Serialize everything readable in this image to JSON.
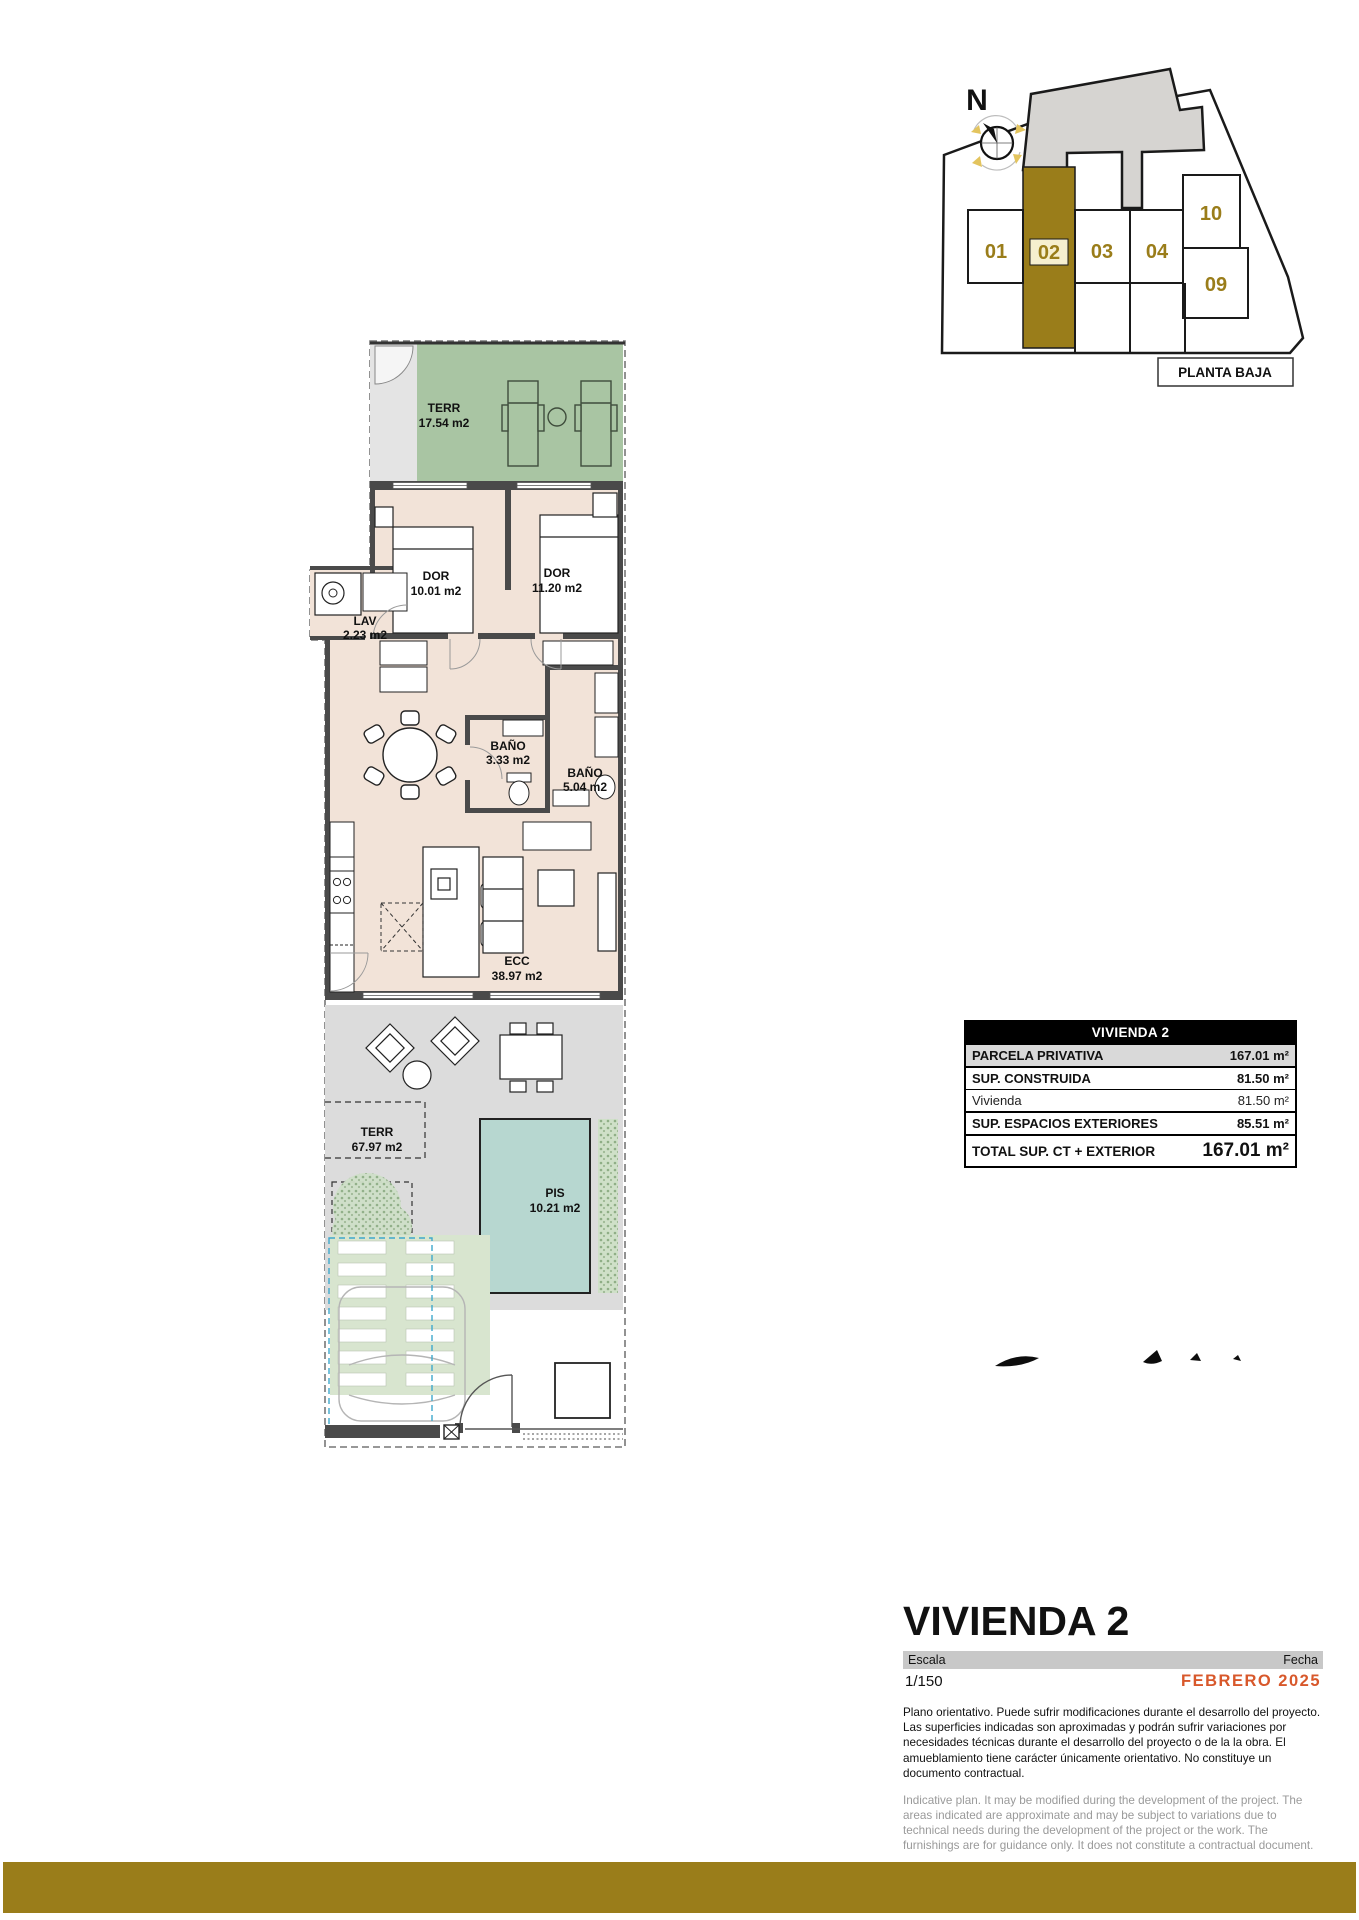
{
  "site_map": {
    "north_label": "N",
    "floor_label": "PLANTA BAJA",
    "units": {
      "u01": "01",
      "u02": "02",
      "u03": "03",
      "u04": "04",
      "u09": "09",
      "u10": "10"
    },
    "highlighted_unit": "02",
    "accent_color": "#9a7d1a"
  },
  "plan": {
    "rooms": {
      "terr_top": {
        "name": "TERR",
        "area": "17.54 m2"
      },
      "dor1": {
        "name": "DOR",
        "area": "10.01 m2"
      },
      "dor2": {
        "name": "DOR",
        "area": "11.20 m2"
      },
      "lav": {
        "name": "LAV",
        "area": "2.23 m2"
      },
      "bano1": {
        "name": "BAÑO",
        "area": "3.33 m2"
      },
      "bano2": {
        "name": "BAÑO",
        "area": "5.04 m2"
      },
      "ecc": {
        "name": "ECC",
        "area": "38.97 m2"
      },
      "terr_bottom": {
        "name": "TERR",
        "area": "67.97 m2"
      },
      "pis": {
        "name": "PIS",
        "area": "10.21 m2"
      }
    }
  },
  "summary_table": {
    "header": "VIVIENDA 2",
    "rows": [
      {
        "label": "PARCELA PRIVATIVA",
        "value": "167.01 m²"
      },
      {
        "label": "SUP. CONSTRUIDA",
        "value": "81.50 m²"
      },
      {
        "label": "Vivienda",
        "value": "81.50 m²"
      },
      {
        "label": "SUP. ESPACIOS EXTERIORES",
        "value": "85.51 m²"
      },
      {
        "label": "TOTAL SUP. CT + EXTERIOR",
        "value": "167.01 m²"
      }
    ]
  },
  "title_block": {
    "title": "VIVIENDA 2",
    "scale_label": "Escala",
    "scale_value": "1/150",
    "date_label": "Fecha",
    "date_value": "FEBRERO 2025",
    "disclaimer_es": "Plano orientativo. Puede sufrir modificaciones durante el desarrollo del proyecto. Las superficies indicadas son aproximadas y podrán sufrir variaciones por necesidades técnicas durante el desarrollo del proyecto o de la la obra. El amueblamiento tiene carácter únicamente orientativo. No constituye un documento contractual.",
    "disclaimer_en": "Indicative plan. It may be modified during the development of the project. The areas indicated are approximate and may be subject to variations due to technical needs during the development of the project or the work. The furnishings are for guidance only. It does not constitute a contractual document."
  },
  "colors": {
    "gold": "#9a7d1a",
    "terrace_green": "#a9c5a3",
    "interior_beige": "#f2e3d8",
    "porch_gray": "#dcdcdc",
    "pool_teal": "#b7d7d0",
    "date_orange": "#d8582b"
  }
}
